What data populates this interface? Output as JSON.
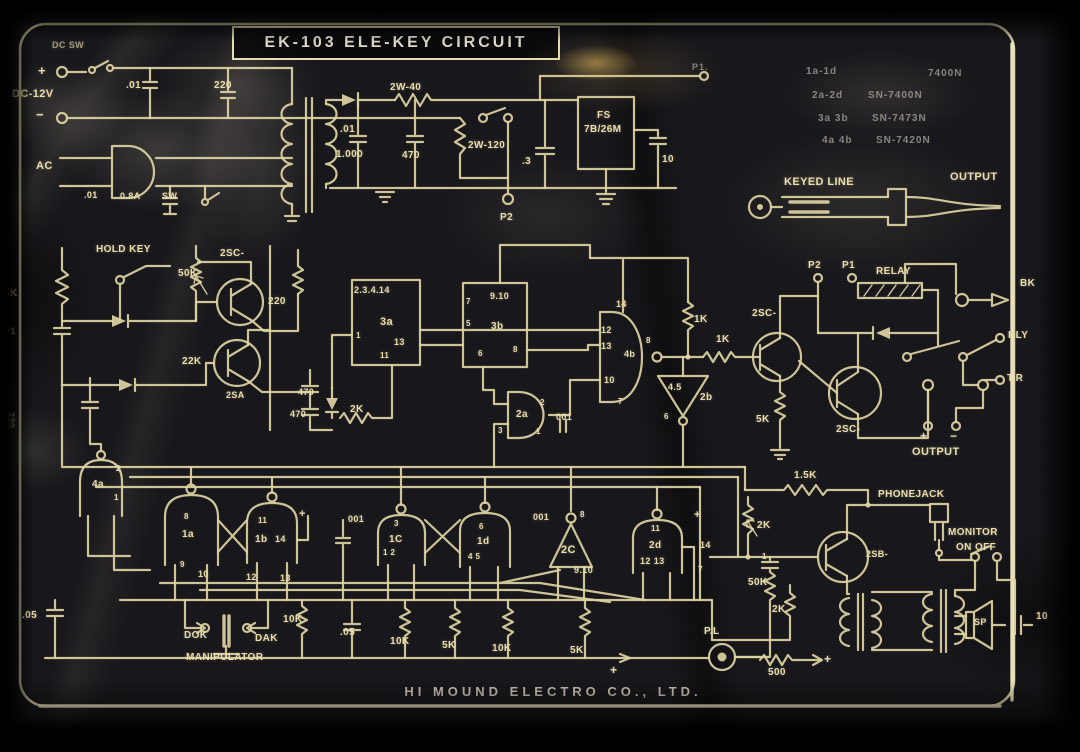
{
  "title": "EK-103 ELE-KEY CIRCUIT",
  "footer": "HI MOUND ELECTRO CO., LTD.",
  "colors": {
    "panel": "#17161a",
    "line": "#dcd2a2",
    "label": "#e8deac",
    "border": "#eae1b6",
    "glare": "#e9be60"
  },
  "ic_assignments": [
    {
      "gates": "1a-1d",
      "part": "7400N"
    },
    {
      "gates": "2a-2d",
      "part": "SN-7400N"
    },
    {
      "gates": "3a 3b",
      "part": "SN-7473N"
    },
    {
      "gates": "4a 4b",
      "part": "SN-7420N"
    }
  ],
  "schematic": {
    "labels": [
      {
        "id": "dc-sw",
        "t": "DC SW",
        "x": 52,
        "y": 40,
        "s": 9,
        "c": "dim"
      },
      {
        "id": "plus-in",
        "t": "+",
        "x": 38,
        "y": 63,
        "s": 13
      },
      {
        "id": "dc-12v",
        "t": "DC-12V",
        "x": 12,
        "y": 88,
        "s": 11
      },
      {
        "id": "minus-in",
        "t": "−",
        "x": 36,
        "y": 107,
        "s": 13
      },
      {
        "id": "cap-01-a",
        "t": ".01",
        "x": 126,
        "y": 80
      },
      {
        "id": "cap-220-a",
        "t": "220",
        "x": 214,
        "y": 80
      },
      {
        "id": "ac",
        "t": "AC",
        "x": 36,
        "y": 160,
        "s": 11
      },
      {
        "id": "cap-01-b",
        "t": ".01",
        "x": 84,
        "y": 190,
        "s": 9
      },
      {
        "id": "fuse-08a",
        "t": "0.8A",
        "x": 120,
        "y": 191,
        "s": 9
      },
      {
        "id": "sw",
        "t": "SW",
        "x": 162,
        "y": 191,
        "s": 9
      },
      {
        "id": "cap-01-c",
        "t": ".01",
        "x": 340,
        "y": 124
      },
      {
        "id": "cap-1000",
        "t": "1.000",
        "x": 336,
        "y": 149
      },
      {
        "id": "cap-470",
        "t": "470",
        "x": 402,
        "y": 150
      },
      {
        "id": "res-2w40",
        "t": "2W-40",
        "x": 390,
        "y": 82
      },
      {
        "id": "res-2w120",
        "t": "2W-120",
        "x": 468,
        "y": 140
      },
      {
        "id": "cap-dot3",
        "t": ".3",
        "x": 522,
        "y": 156
      },
      {
        "id": "fs-1",
        "t": "FS",
        "x": 597,
        "y": 110
      },
      {
        "id": "fs-2",
        "t": "7B/26M",
        "x": 584,
        "y": 124
      },
      {
        "id": "cap-10",
        "t": "10",
        "x": 662,
        "y": 154
      },
      {
        "id": "p2-top",
        "t": "P2",
        "x": 500,
        "y": 212
      },
      {
        "id": "p1-top",
        "t": "P1.",
        "x": 692,
        "y": 62,
        "s": 9,
        "c": "faint"
      },
      {
        "id": "ic-1a",
        "t": "1a-1d",
        "x": 806,
        "y": 66,
        "s": 10,
        "c": "faint"
      },
      {
        "id": "ic-1b",
        "t": "7400N",
        "x": 928,
        "y": 68,
        "s": 10,
        "c": "faint"
      },
      {
        "id": "ic-2a",
        "t": "2a-2d",
        "x": 812,
        "y": 90,
        "s": 10,
        "c": "faint"
      },
      {
        "id": "ic-2b",
        "t": "SN-7400N",
        "x": 868,
        "y": 90,
        "s": 10,
        "c": "faint"
      },
      {
        "id": "ic-3a",
        "t": "3a 3b",
        "x": 818,
        "y": 113,
        "s": 10,
        "c": "faint"
      },
      {
        "id": "ic-3b",
        "t": "SN-7473N",
        "x": 872,
        "y": 113,
        "s": 10,
        "c": "faint"
      },
      {
        "id": "ic-4a",
        "t": "4a 4b",
        "x": 822,
        "y": 135,
        "s": 10,
        "c": "faint"
      },
      {
        "id": "ic-4b",
        "t": "SN-7420N",
        "x": 876,
        "y": 135,
        "s": 10,
        "c": "faint"
      },
      {
        "id": "keyed-line",
        "t": "KEYED LINE",
        "x": 784,
        "y": 176,
        "s": 11
      },
      {
        "id": "output-top",
        "t": "OUTPUT",
        "x": 950,
        "y": 171,
        "s": 11
      },
      {
        "id": "hold-key",
        "t": "HOLD KEY",
        "x": 96,
        "y": 244
      },
      {
        "id": "res-5k-left",
        "t": "5K",
        "x": 4,
        "y": 288
      },
      {
        "id": "cap-01-left",
        "t": ".01",
        "x": 2,
        "y": 326,
        "s": 9
      },
      {
        "id": "pot-50k",
        "t": "50K",
        "x": 178,
        "y": 268
      },
      {
        "id": "q1",
        "t": "2SC-",
        "x": 220,
        "y": 248
      },
      {
        "id": "res-220-b",
        "t": "220",
        "x": 268,
        "y": 296
      },
      {
        "id": "res-22k",
        "t": "22K",
        "x": 182,
        "y": 356
      },
      {
        "id": "q2",
        "t": "2SA",
        "x": 226,
        "y": 390,
        "s": 9
      },
      {
        "id": "cap-470-a",
        "t": "470",
        "x": 298,
        "y": 387,
        "s": 9
      },
      {
        "id": "cap-470-b",
        "t": "470",
        "x": 290,
        "y": 409,
        "s": 9
      },
      {
        "id": "res-2k-a",
        "t": "2K",
        "x": 350,
        "y": 404
      },
      {
        "id": "cap-220-vert",
        "t": "220",
        "x": 16,
        "y": 412,
        "s": 9,
        "c": "rot"
      },
      {
        "id": "ic3a-pins",
        "t": "2.3.4.14",
        "x": 354,
        "y": 285,
        "s": 9
      },
      {
        "id": "ic3a",
        "t": "3a",
        "x": 380,
        "y": 316,
        "s": 11
      },
      {
        "id": "pin-1",
        "t": "1",
        "x": 356,
        "y": 331,
        "s": 8
      },
      {
        "id": "pin-13",
        "t": "13",
        "x": 394,
        "y": 337,
        "s": 9
      },
      {
        "id": "pin-11",
        "t": "11",
        "x": 380,
        "y": 351,
        "s": 8
      },
      {
        "id": "pin-7",
        "t": "7",
        "x": 466,
        "y": 297,
        "s": 8
      },
      {
        "id": "pin-910",
        "t": "9.10",
        "x": 490,
        "y": 291,
        "s": 9
      },
      {
        "id": "pin-5",
        "t": "5",
        "x": 466,
        "y": 319,
        "s": 8
      },
      {
        "id": "ic3b",
        "t": "3b",
        "x": 491,
        "y": 321,
        "s": 10
      },
      {
        "id": "pin-6",
        "t": "6",
        "x": 478,
        "y": 349,
        "s": 8
      },
      {
        "id": "pin-8a",
        "t": "8",
        "x": 513,
        "y": 345,
        "s": 8
      },
      {
        "id": "pin-14",
        "t": "14",
        "x": 616,
        "y": 299,
        "s": 9
      },
      {
        "id": "pin-12",
        "t": "12",
        "x": 601,
        "y": 325,
        "s": 9
      },
      {
        "id": "pin-13b",
        "t": "13",
        "x": 601,
        "y": 341,
        "s": 9
      },
      {
        "id": "gate-4b",
        "t": "4b",
        "x": 624,
        "y": 349,
        "s": 9
      },
      {
        "id": "pin-10",
        "t": "10",
        "x": 604,
        "y": 375,
        "s": 9
      },
      {
        "id": "pin-8b",
        "t": "8",
        "x": 646,
        "y": 336,
        "s": 8
      },
      {
        "id": "pin-7b",
        "t": "7",
        "x": 618,
        "y": 397,
        "s": 8
      },
      {
        "id": "res-1k-a",
        "t": "1K",
        "x": 694,
        "y": 314
      },
      {
        "id": "res-1k-b",
        "t": "1K",
        "x": 716,
        "y": 334
      },
      {
        "id": "inv-2b-45",
        "t": "4.5",
        "x": 668,
        "y": 382,
        "s": 9
      },
      {
        "id": "inv-2b",
        "t": "2b",
        "x": 700,
        "y": 392
      },
      {
        "id": "pin-6b",
        "t": "6",
        "x": 664,
        "y": 412,
        "s": 8
      },
      {
        "id": "q3",
        "t": "2SC-",
        "x": 752,
        "y": 308
      },
      {
        "id": "res-5k-mid",
        "t": "5K",
        "x": 756,
        "y": 414
      },
      {
        "id": "q4",
        "t": "2SC-",
        "x": 836,
        "y": 424
      },
      {
        "id": "p2-relay",
        "t": "P2",
        "x": 808,
        "y": 260
      },
      {
        "id": "p1-relay",
        "t": "P1",
        "x": 842,
        "y": 260
      },
      {
        "id": "relay",
        "t": "RELAY",
        "x": 876,
        "y": 266
      },
      {
        "id": "bk",
        "t": "BK",
        "x": 1020,
        "y": 278
      },
      {
        "id": "rly",
        "t": "RLY",
        "x": 1008,
        "y": 330
      },
      {
        "id": "tr",
        "t": "T.R",
        "x": 1007,
        "y": 373
      },
      {
        "id": "output-mid",
        "t": "OUTPUT",
        "x": 912,
        "y": 446,
        "s": 11
      },
      {
        "id": "plus-out",
        "t": "+",
        "x": 920,
        "y": 429,
        "s": 12
      },
      {
        "id": "minus-out",
        "t": "−",
        "x": 950,
        "y": 429,
        "s": 12
      },
      {
        "id": "gate-2a",
        "t": "2a",
        "x": 516,
        "y": 409
      },
      {
        "id": "pin-2a2",
        "t": "2",
        "x": 540,
        "y": 398,
        "s": 8
      },
      {
        "id": "pin-2a3",
        "t": "3",
        "x": 498,
        "y": 426,
        "s": 8
      },
      {
        "id": "pin-2a1",
        "t": "1",
        "x": 536,
        "y": 427,
        "s": 8
      },
      {
        "id": "cap-001-a",
        "t": "001",
        "x": 556,
        "y": 412,
        "s": 9
      },
      {
        "id": "res-15k",
        "t": "1.5K",
        "x": 794,
        "y": 470
      },
      {
        "id": "res-2k-b",
        "t": "2K",
        "x": 757,
        "y": 520
      },
      {
        "id": "cap-1",
        "t": "1",
        "x": 762,
        "y": 552,
        "s": 8
      },
      {
        "id": "pot-50k-b",
        "t": "50K",
        "x": 748,
        "y": 577
      },
      {
        "id": "res-2k-c",
        "t": "2K",
        "x": 772,
        "y": 604
      },
      {
        "id": "phone-jack",
        "t": "PHONEJACK",
        "x": 878,
        "y": 489
      },
      {
        "id": "monitor",
        "t": "MONITOR",
        "x": 948,
        "y": 527
      },
      {
        "id": "on-off",
        "t": "ON OFF",
        "x": 956,
        "y": 542
      },
      {
        "id": "q5",
        "t": "2SB-",
        "x": 866,
        "y": 549,
        "s": 9
      },
      {
        "id": "sp",
        "t": "SP",
        "x": 974,
        "y": 617,
        "s": 9
      },
      {
        "id": "cap-10-b",
        "t": "10",
        "x": 1036,
        "y": 611
      },
      {
        "id": "pl",
        "t": "P.L",
        "x": 704,
        "y": 626
      },
      {
        "id": "res-500",
        "t": "500",
        "x": 768,
        "y": 667
      },
      {
        "id": "plus-pl",
        "t": "+",
        "x": 824,
        "y": 652,
        "s": 12
      },
      {
        "id": "plus-rail",
        "t": "+",
        "x": 610,
        "y": 663,
        "s": 12
      },
      {
        "id": "gate-1a",
        "t": "1a",
        "x": 182,
        "y": 529
      },
      {
        "id": "pin-g8",
        "t": "8",
        "x": 184,
        "y": 512,
        "s": 8
      },
      {
        "id": "pin-g9",
        "t": "9",
        "x": 180,
        "y": 560,
        "s": 8
      },
      {
        "id": "pin-g10",
        "t": "10",
        "x": 198,
        "y": 569,
        "s": 9
      },
      {
        "id": "gate-1b",
        "t": "1b",
        "x": 255,
        "y": 534
      },
      {
        "id": "pin-g11",
        "t": "11",
        "x": 258,
        "y": 516,
        "s": 8
      },
      {
        "id": "pin-g14",
        "t": "14",
        "x": 275,
        "y": 534,
        "s": 9
      },
      {
        "id": "pin-g12",
        "t": "12",
        "x": 246,
        "y": 572,
        "s": 9
      },
      {
        "id": "pin-g13",
        "t": "13",
        "x": 280,
        "y": 573,
        "s": 9
      },
      {
        "id": "plus-1b",
        "t": "+",
        "x": 299,
        "y": 508,
        "s": 11
      },
      {
        "id": "cap-001-b",
        "t": "001",
        "x": 348,
        "y": 514,
        "s": 9
      },
      {
        "id": "gate-1c",
        "t": "1C",
        "x": 389,
        "y": 534
      },
      {
        "id": "pin-g3",
        "t": "3",
        "x": 394,
        "y": 519,
        "s": 8
      },
      {
        "id": "pin-g12b",
        "t": "1 2",
        "x": 383,
        "y": 548,
        "s": 8
      },
      {
        "id": "gate-1d",
        "t": "1d",
        "x": 477,
        "y": 536
      },
      {
        "id": "pin-g6",
        "t": "6",
        "x": 479,
        "y": 522,
        "s": 8
      },
      {
        "id": "pin-g45",
        "t": "4 5",
        "x": 468,
        "y": 552,
        "s": 8
      },
      {
        "id": "inv-2c",
        "t": "2C",
        "x": 561,
        "y": 544,
        "s": 11
      },
      {
        "id": "pin-g8b",
        "t": "8",
        "x": 580,
        "y": 510,
        "s": 8
      },
      {
        "id": "cap-001-c",
        "t": "001",
        "x": 533,
        "y": 512,
        "s": 9
      },
      {
        "id": "pin-910b",
        "t": "9.10",
        "x": 574,
        "y": 565,
        "s": 9
      },
      {
        "id": "gate-2d",
        "t": "2d",
        "x": 649,
        "y": 540
      },
      {
        "id": "pin-g11b",
        "t": "11",
        "x": 651,
        "y": 524,
        "s": 8
      },
      {
        "id": "pin-g1213",
        "t": "12 13",
        "x": 640,
        "y": 556,
        "s": 9
      },
      {
        "id": "pin-g14b",
        "t": "14",
        "x": 700,
        "y": 540,
        "s": 9
      },
      {
        "id": "pin-g7",
        "t": "7",
        "x": 698,
        "y": 565,
        "s": 8
      },
      {
        "id": "plus-2d",
        "t": "+",
        "x": 694,
        "y": 509,
        "s": 11
      },
      {
        "id": "gate-4a",
        "t": "4a",
        "x": 92,
        "y": 479
      },
      {
        "id": "pin-4a2",
        "t": "2",
        "x": 116,
        "y": 464,
        "s": 8
      },
      {
        "id": "pin-4a1",
        "t": "1",
        "x": 114,
        "y": 493,
        "s": 8
      },
      {
        "id": "dok",
        "t": "DOK",
        "x": 184,
        "y": 630
      },
      {
        "id": "dak",
        "t": "DAK",
        "x": 255,
        "y": 633
      },
      {
        "id": "manipulator",
        "t": "MANIPULATOR",
        "x": 186,
        "y": 652
      },
      {
        "id": "cap-05-a",
        "t": ".05",
        "x": 22,
        "y": 610
      },
      {
        "id": "res-10k-a",
        "t": "10K",
        "x": 283,
        "y": 614
      },
      {
        "id": "cap-05-b",
        "t": ".05",
        "x": 340,
        "y": 627
      },
      {
        "id": "res-10k-b",
        "t": "10K",
        "x": 390,
        "y": 636
      },
      {
        "id": "res-5k-a",
        "t": "5K",
        "x": 442,
        "y": 640
      },
      {
        "id": "res-10k-c",
        "t": "10K",
        "x": 492,
        "y": 643
      },
      {
        "id": "res-5k-b",
        "t": "5K",
        "x": 570,
        "y": 645
      }
    ]
  }
}
